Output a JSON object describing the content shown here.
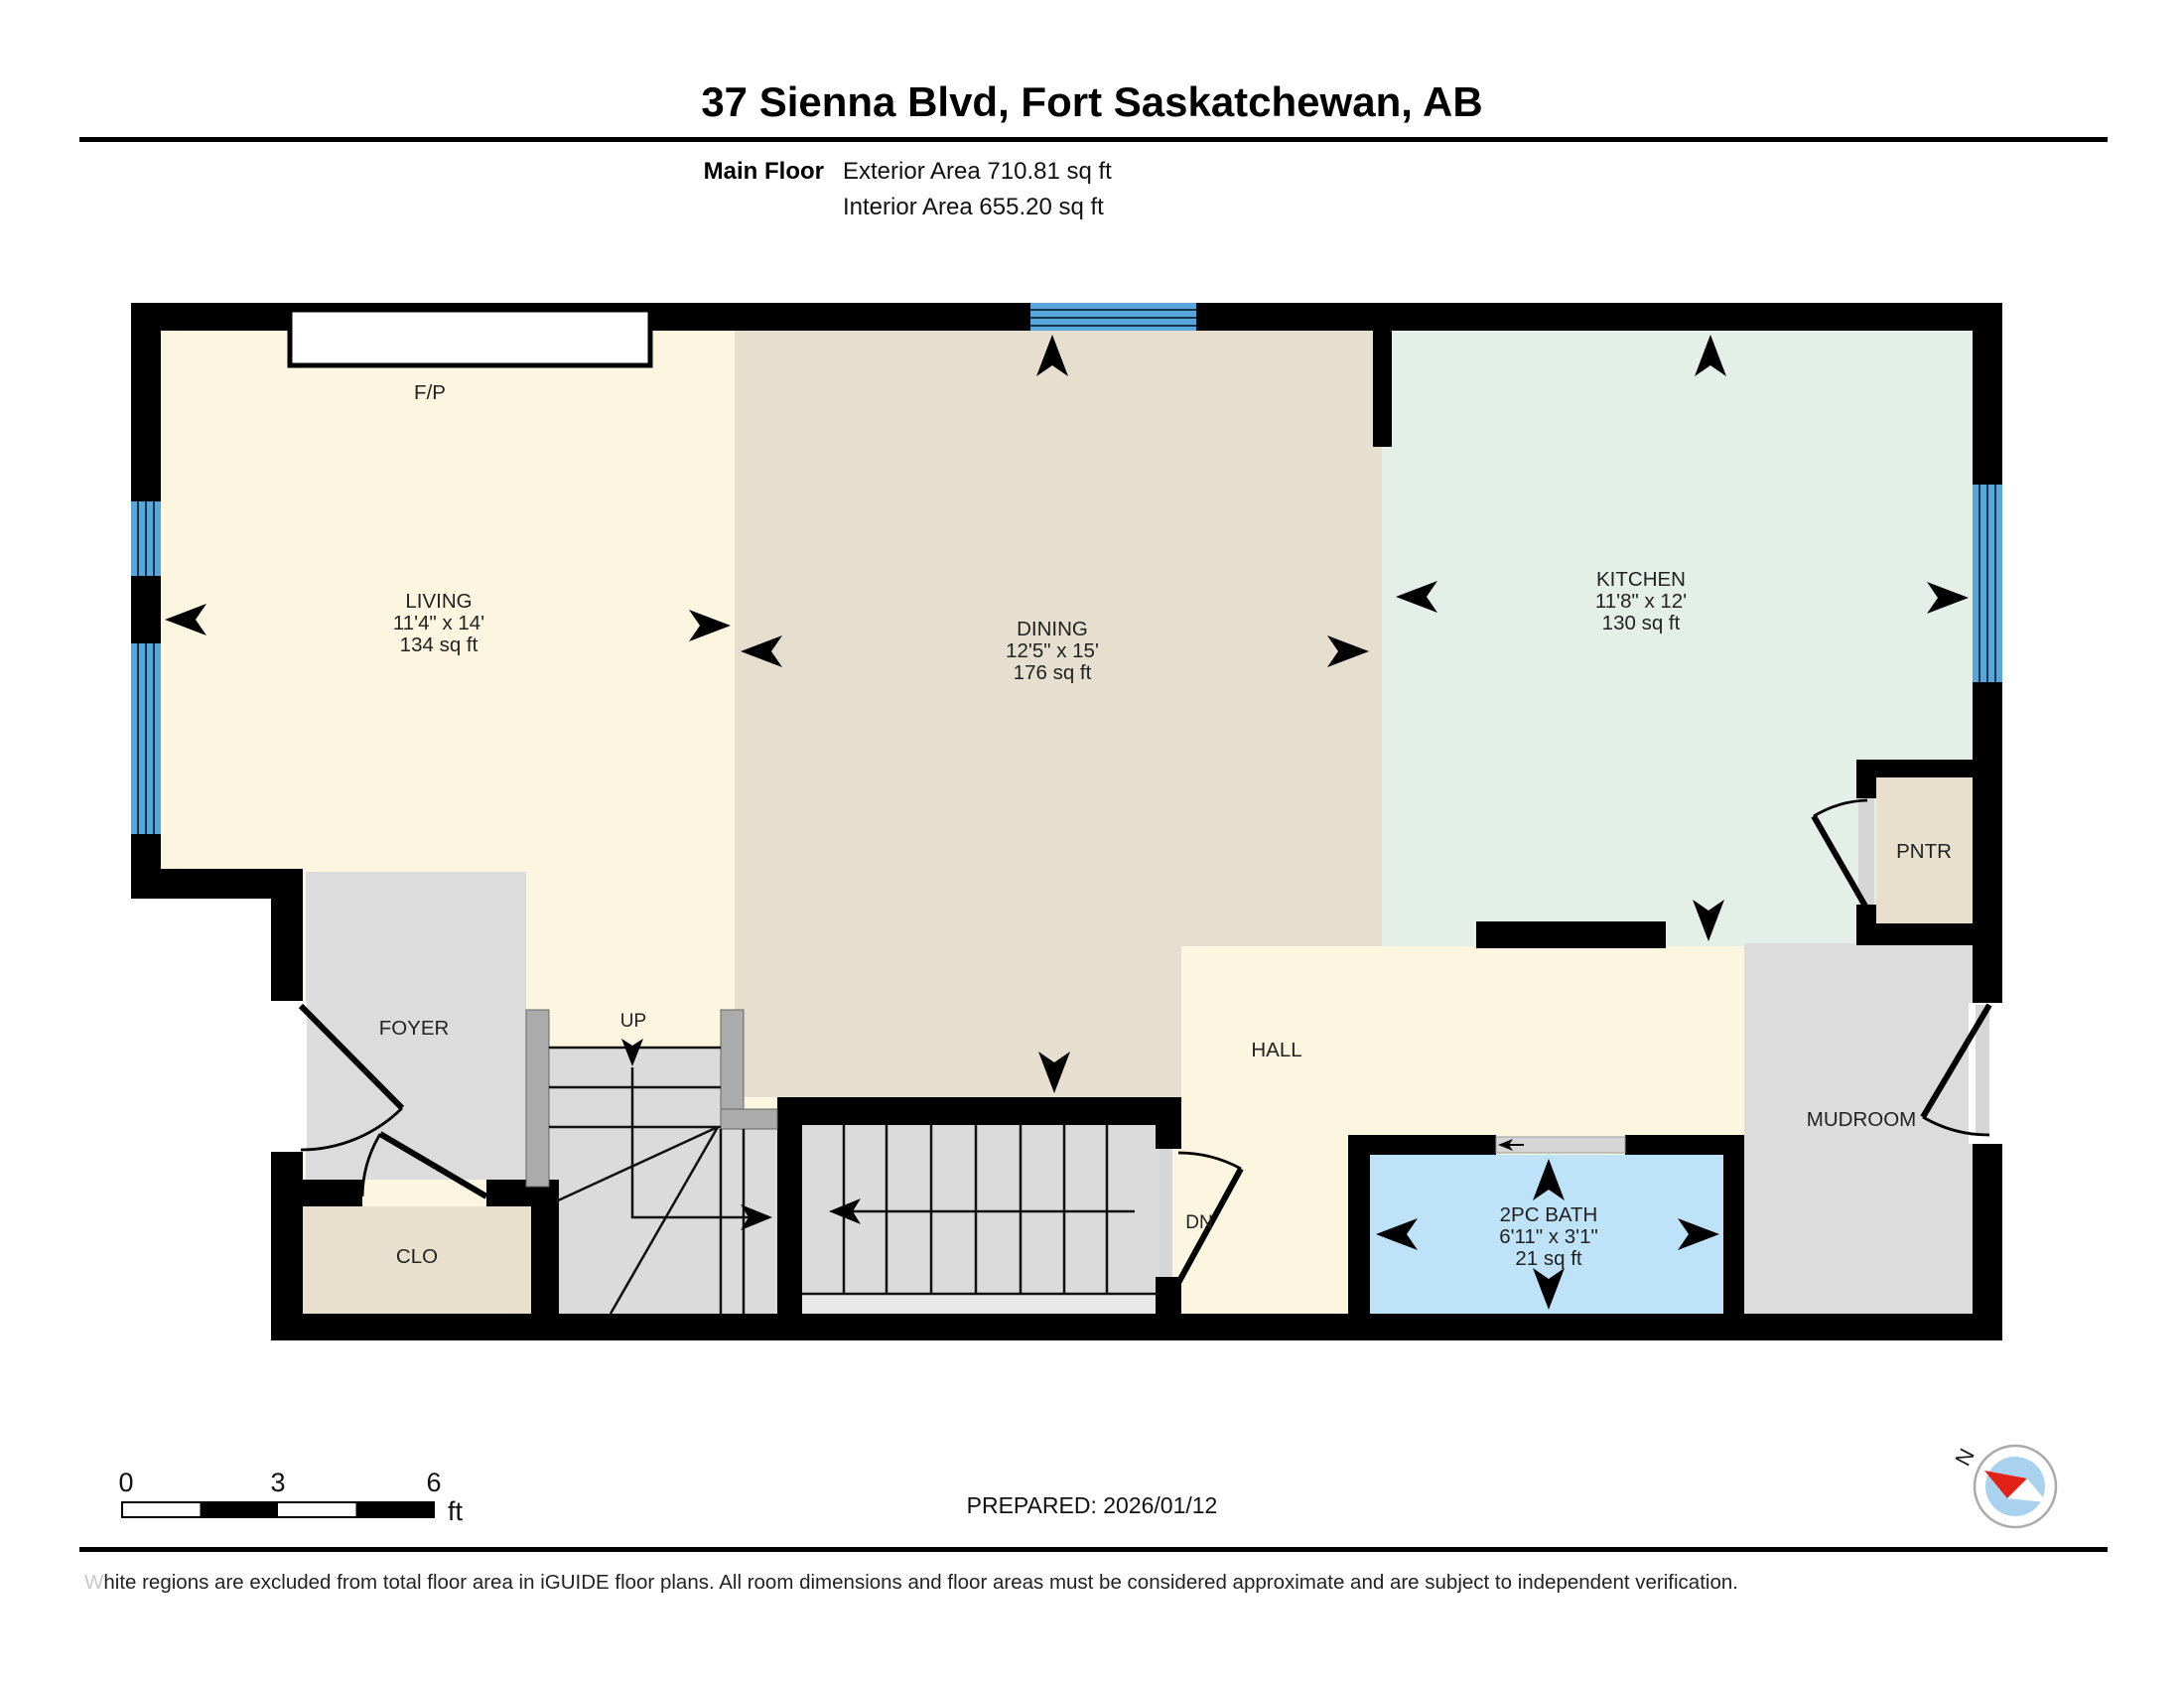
{
  "header": {
    "title": "37 Sienna Blvd, Fort Saskatchewan, AB",
    "floor_label": "Main Floor",
    "exterior_area": "Exterior Area 710.81 sq ft",
    "interior_area": "Interior Area 655.20 sq ft"
  },
  "rooms": {
    "living": {
      "name": "LIVING",
      "dims": "11'4\" x 14'",
      "area": "134 sq ft"
    },
    "dining": {
      "name": "DINING",
      "dims": "12'5\" x 15'",
      "area": "176 sq ft"
    },
    "kitchen": {
      "name": "KITCHEN",
      "dims": "11'8\" x 12'",
      "area": "130 sq ft"
    },
    "bath": {
      "name": "2PC BATH",
      "dims": "6'11\" x 3'1\"",
      "area": "21 sq ft"
    },
    "foyer": {
      "name": "FOYER"
    },
    "hall": {
      "name": "HALL"
    },
    "mudroom": {
      "name": "MUDROOM"
    },
    "closet": {
      "name": "CLO"
    },
    "pantry": {
      "name": "PNTR"
    },
    "fireplace": {
      "name": "F/P"
    },
    "stairs_up": {
      "name": "UP"
    },
    "stairs_down": {
      "name": "DN"
    }
  },
  "scale_bar": {
    "start": "0",
    "mid": "3",
    "end": "6",
    "unit": "ft"
  },
  "footer": {
    "prepared": "PREPARED: 2026/01/12",
    "disclaimer_first": "W",
    "disclaimer_rest": "hite regions are excluded from total floor area in iGUIDE floor plans. All room dimensions and floor areas must be considered approximate and are subject to independent verification."
  },
  "compass": {
    "label": "N"
  },
  "colors": {
    "living_floor": "#FCF5DF",
    "dining_floor": "#E6DFD0",
    "kitchen_floor": "#E4EFE7",
    "gray_floor": "#DCDCDC",
    "closet_floor": "#E8DFCC",
    "bath_floor": "#BEE2F8",
    "stair_floor": "#DBDBDB",
    "landing_floor": "#E8E8E8",
    "railing": "#ABABAB",
    "window": "#59A7DA",
    "door_recess": "#D6D6D6",
    "wall": "#000000",
    "compass_inner": "#A9D2EE",
    "compass_needle": "#E32119"
  }
}
